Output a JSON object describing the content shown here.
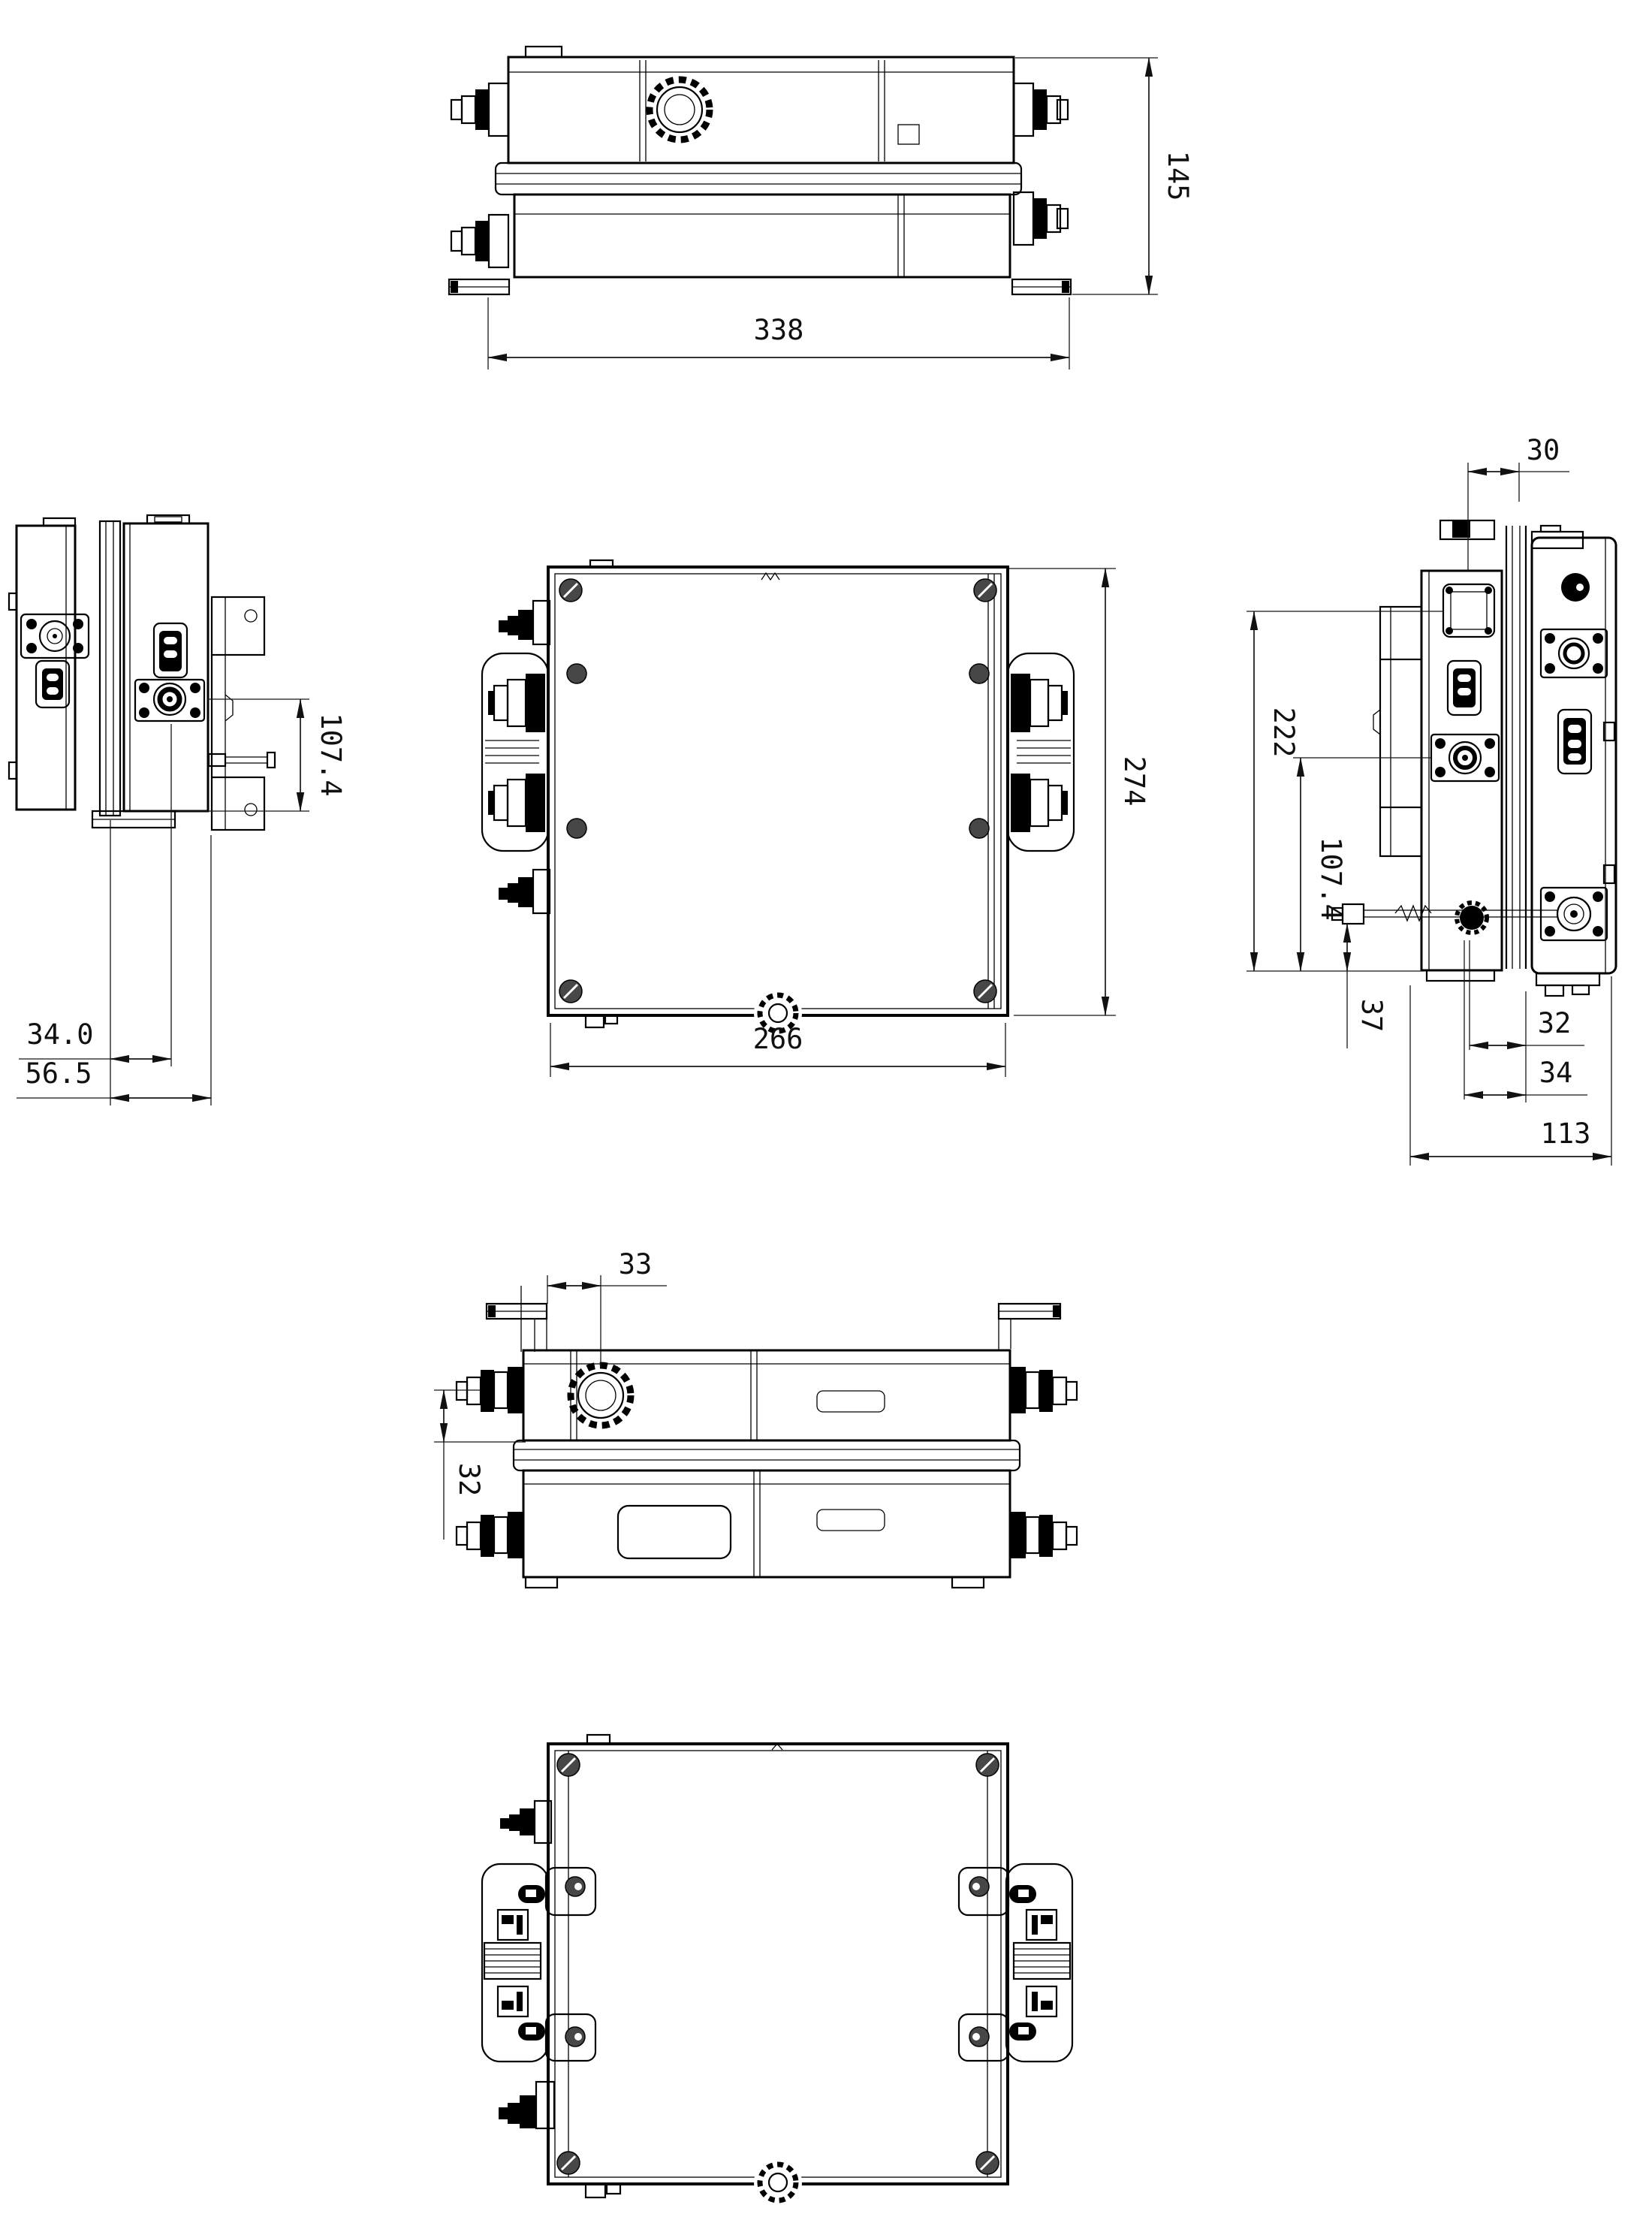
{
  "page": {
    "background": "#ffffff",
    "line_color": "#000000"
  },
  "views": {
    "top": {
      "title": "top-view",
      "dim_depth": "145",
      "dim_width": "338"
    },
    "left_side": {
      "title": "left-side-view",
      "dim_conn": "34.0",
      "dim_edge": "56.5",
      "dim_height": "107.4"
    },
    "front": {
      "title": "front-view",
      "dim_width": "266",
      "dim_height": "274"
    },
    "right_side": {
      "title": "right-side-view",
      "dim_port": "30",
      "dim_height": "222",
      "dim_conn": "107.4",
      "dim_pin": "37",
      "dim_a": "32",
      "dim_b": "34",
      "dim_depth": "113"
    },
    "rear": {
      "title": "rear-view",
      "dim_knob": "33",
      "dim_conn": "32"
    },
    "bottom": {
      "title": "bottom-view"
    }
  }
}
